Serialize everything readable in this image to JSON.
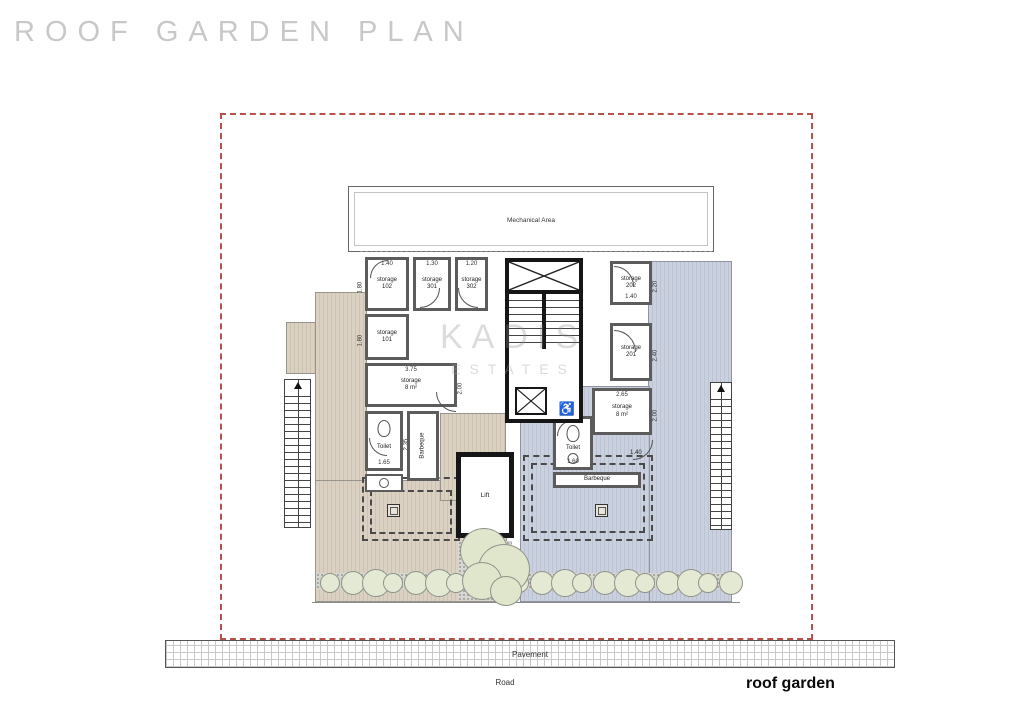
{
  "title": "ROOF GARDEN PLAN",
  "watermark": {
    "line1": "KADIS",
    "line2": "ESTATES"
  },
  "mech": {
    "label": "Mechanical Area"
  },
  "core": {
    "lift_label": "Lift"
  },
  "site": {
    "pavement_label": "Pavement",
    "road_label": "Road",
    "caption": "roof garden"
  },
  "rooms": [
    {
      "id": "storage-102",
      "line1": "storage",
      "line2": "102",
      "dim_top": "1.40",
      "dim_left": "1.80"
    },
    {
      "id": "storage-301",
      "line1": "storage",
      "line2": "301",
      "dim_top": "1.30"
    },
    {
      "id": "storage-302",
      "line1": "storage",
      "line2": "302",
      "dim_top": "1.20"
    },
    {
      "id": "storage-101",
      "line1": "storage",
      "line2": "101",
      "dim_left": "1.80"
    },
    {
      "id": "storage-left-8sqm",
      "line1": "storage",
      "line2": "8 m²",
      "dim_top": "3.75",
      "dim_right": "2.00"
    },
    {
      "id": "toilet-left",
      "line1": "Toilet",
      "dim_bottom": "1.65",
      "dim_right": "2.35"
    },
    {
      "id": "barbeque-left",
      "line1": "Barbeque"
    },
    {
      "id": "storage-202",
      "line1": "storage",
      "line2": "202",
      "dim_right": "2.20",
      "dim_bottom": "1.40"
    },
    {
      "id": "storage-201",
      "line1": "storage",
      "line2": "201",
      "dim_right": "2.40"
    },
    {
      "id": "storage-right-8sqm",
      "line1": "storage",
      "line2": "8 m²",
      "dim_top": "2.65",
      "dim_right": "2.00"
    },
    {
      "id": "toilet-right",
      "line1": "Toilet",
      "dim_bottom": "1.60"
    },
    {
      "id": "barbeque-right",
      "line1": "Barbeque",
      "dim_near_door": "1.40"
    }
  ],
  "colors": {
    "boundary_red": "#b5524c",
    "deck_beige": "#dad1c2",
    "deck_blue": "#cad0dd",
    "wall_gray": "#5c5c5c",
    "core_black": "#161616",
    "shrub_green": "#e3e9d2",
    "title_gray": "#c8c8c8"
  }
}
